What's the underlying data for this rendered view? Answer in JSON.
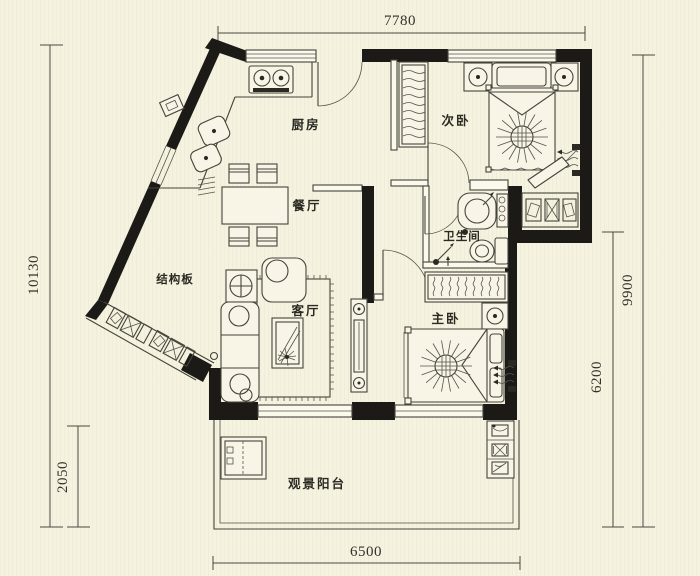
{
  "plan_type": "apartment-floor-plan",
  "rooms": {
    "kitchen": {
      "label": "厨房"
    },
    "second_bedroom": {
      "label": "次卧"
    },
    "dining": {
      "label": "餐厅"
    },
    "bathroom": {
      "label": "卫生间"
    },
    "structural_slab": {
      "label": "结构板"
    },
    "living": {
      "label": "客厅"
    },
    "master_bedroom": {
      "label": "主卧"
    },
    "balcony": {
      "label": "观景阳台"
    }
  },
  "dimensions": {
    "top": "7780",
    "left_total": "10130",
    "left_lower": "2050",
    "right_total": "9900",
    "right_lower": "6200",
    "bottom": "6500"
  },
  "colors": {
    "background": "#f5f2df",
    "wall": "#1b1a16",
    "line": "#45443a",
    "text": "#2b2a22"
  }
}
